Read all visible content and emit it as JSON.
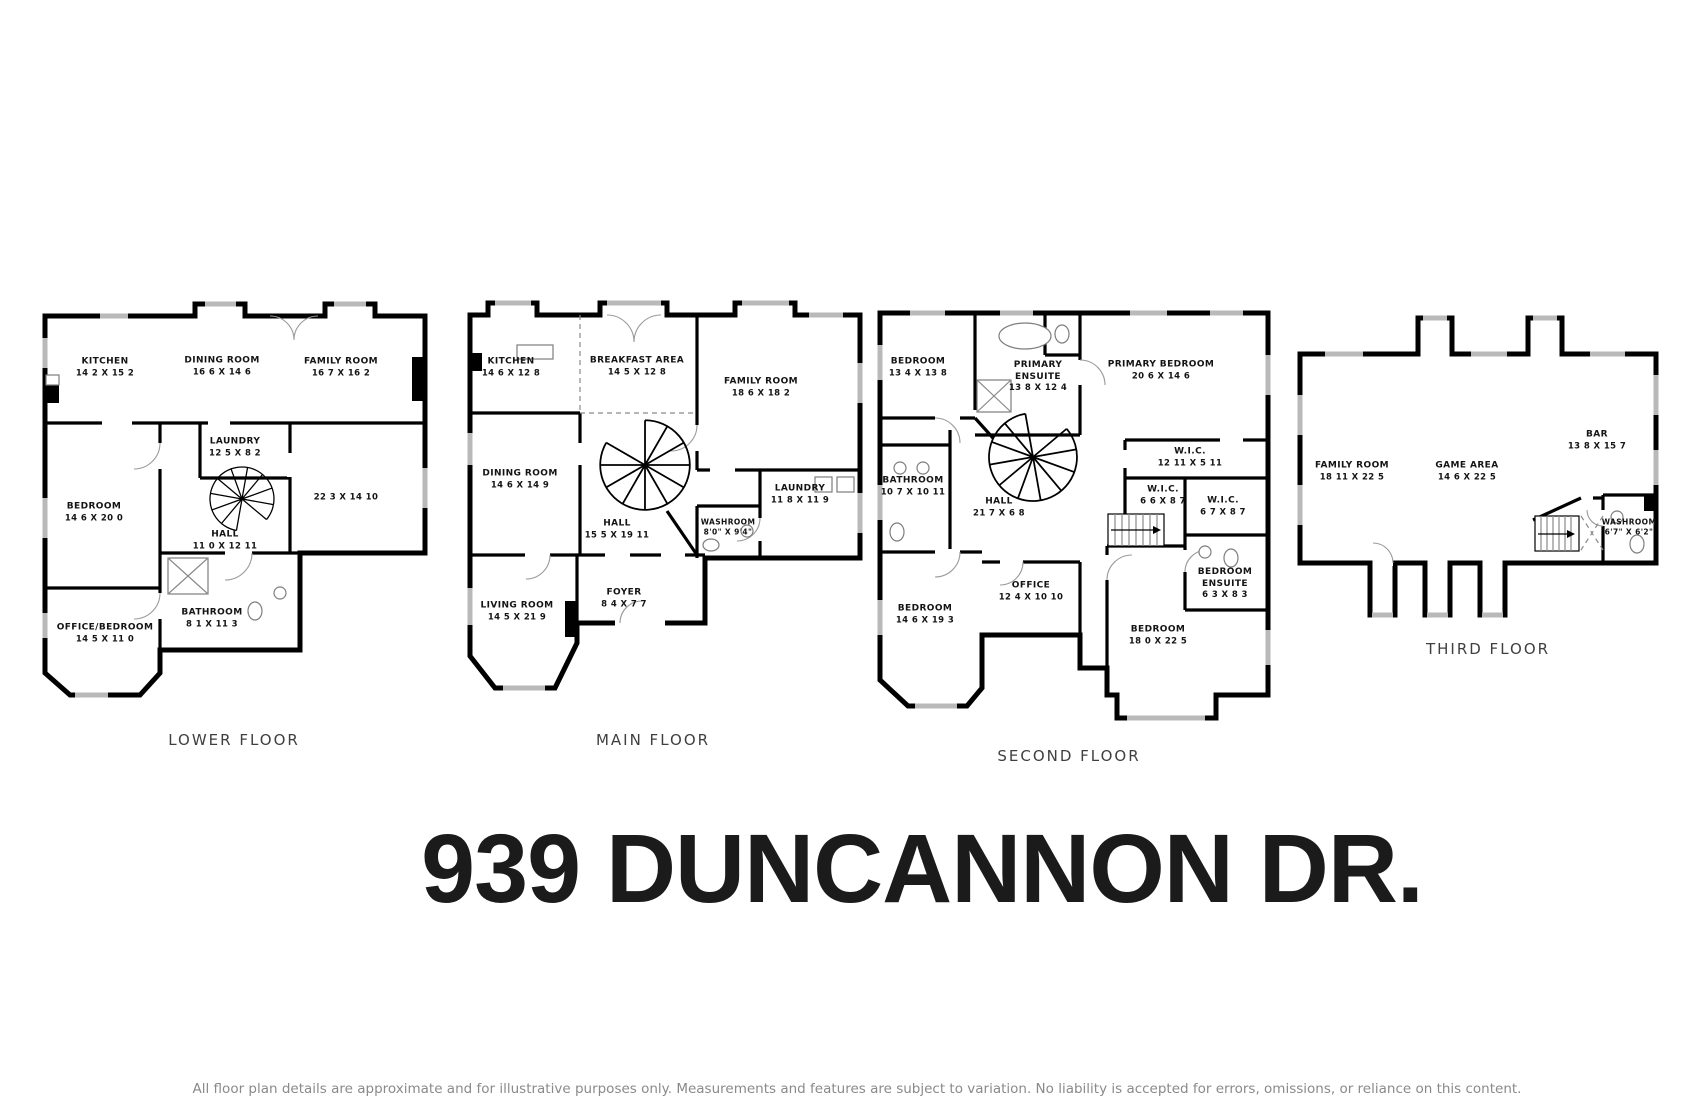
{
  "title": "939 DUNCANNON DR.",
  "disclaimer": "All floor plan details are approximate and for illustrative purposes only. Measurements and features are subject to variation. No liability is accepted for errors, omissions, or reliance on this content.",
  "colors": {
    "wall": "#000000",
    "window": "#b9b9b9",
    "room_text": "#141414",
    "caption_text": "#3f3f3f",
    "disclaimer_text": "#8a8a8a"
  },
  "floors": [
    {
      "label": "LOWER FLOOR",
      "rooms": [
        {
          "name": "KITCHEN",
          "dims": "14 2 X 15 2"
        },
        {
          "name": "DINING ROOM",
          "dims": "16 6 X 14 6"
        },
        {
          "name": "FAMILY ROOM",
          "dims": "16 7 X 16 2"
        },
        {
          "name": "LAUNDRY",
          "dims": "12 5 X 8 2"
        },
        {
          "name": "",
          "dims": "22 3 X 14 10"
        },
        {
          "name": "BEDROOM",
          "dims": "14 6 X 20 0"
        },
        {
          "name": "HALL",
          "dims": "11 0 X 12 11"
        },
        {
          "name": "BATHROOM",
          "dims": "8 1 X 11 3"
        },
        {
          "name": "OFFICE/BEDROOM",
          "dims": "14 5 X 11 0"
        }
      ]
    },
    {
      "label": "MAIN FLOOR",
      "rooms": [
        {
          "name": "KITCHEN",
          "dims": "14 6 X 12 8"
        },
        {
          "name": "BREAKFAST AREA",
          "dims": "14 5 X 12 8"
        },
        {
          "name": "FAMILY ROOM",
          "dims": "18 6 X 18 2"
        },
        {
          "name": "DINING ROOM",
          "dims": "14 6 X 14 9"
        },
        {
          "name": "HALL",
          "dims": "15 5 X 19 11"
        },
        {
          "name": "LAUNDRY",
          "dims": "11 8 X 11 9"
        },
        {
          "name": "WASHROOM",
          "dims": "8'0\" X 9'4\""
        },
        {
          "name": "FOYER",
          "dims": "8 4 X 7 7"
        },
        {
          "name": "LIVING ROOM",
          "dims": "14 5 X 21 9"
        }
      ]
    },
    {
      "label": "SECOND FLOOR",
      "rooms": [
        {
          "name": "BEDROOM",
          "dims": "13 4 X 13 8"
        },
        {
          "name": "PRIMARY ENSUITE",
          "dims": "13 8 X 12 4"
        },
        {
          "name": "PRIMARY BEDROOM",
          "dims": "20 6 X 14 6"
        },
        {
          "name": "BATHROOM",
          "dims": "10 7 X 10 11"
        },
        {
          "name": "HALL",
          "dims": "21 7 X 6 8"
        },
        {
          "name": "W.I.C.",
          "dims": "12 11 X 5 11"
        },
        {
          "name": "W.I.C.",
          "dims": "6 6 X 8 7"
        },
        {
          "name": "W.I.C.",
          "dims": "6 7 X 8 7"
        },
        {
          "name": "OFFICE",
          "dims": "12 4 X 10 10"
        },
        {
          "name": "BEDROOM ENSUITE",
          "dims": "6 3 X 8 3"
        },
        {
          "name": "BEDROOM",
          "dims": "14 6 X 19 3"
        },
        {
          "name": "BEDROOM",
          "dims": "18 0 X 22 5"
        }
      ]
    },
    {
      "label": "THIRD FLOOR",
      "rooms": [
        {
          "name": "FAMILY ROOM",
          "dims": "18 11 X 22 5"
        },
        {
          "name": "GAME AREA",
          "dims": "14 6 X 22 5"
        },
        {
          "name": "BAR",
          "dims": "13 8 X 15 7"
        },
        {
          "name": "WASHROOM",
          "dims": "6'7\" X 6'2\""
        }
      ]
    }
  ]
}
